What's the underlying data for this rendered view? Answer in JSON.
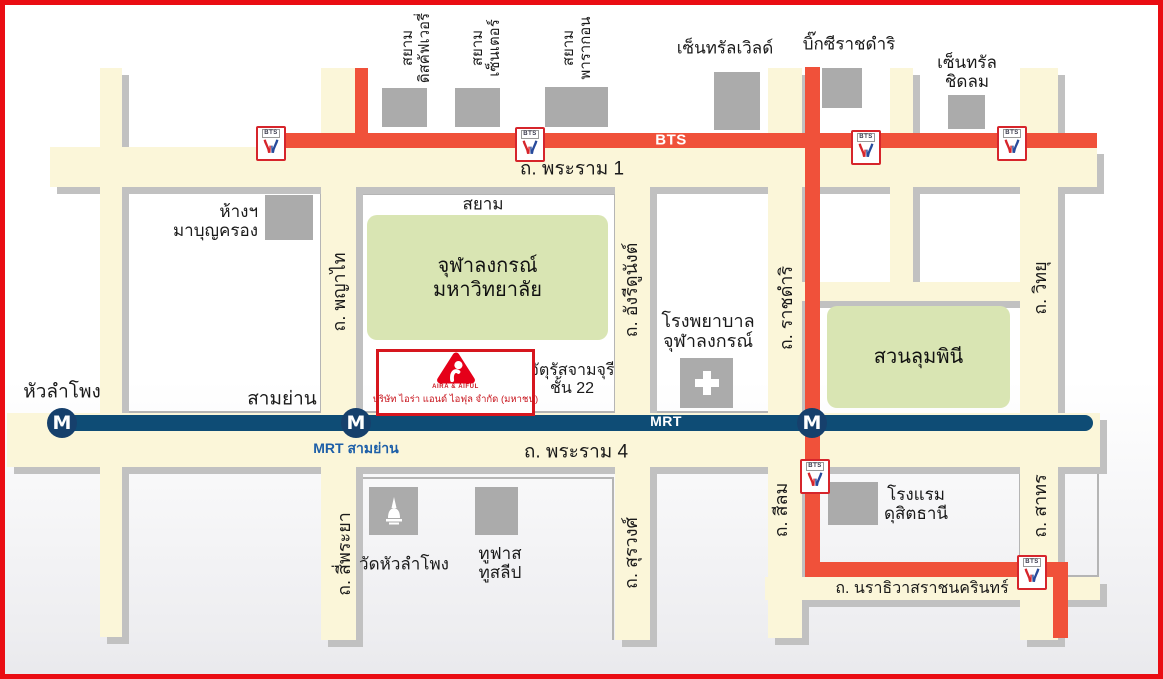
{
  "map": {
    "colors": {
      "frame_red": "#ea0d13",
      "road_cream": "#fbf6d9",
      "road_shadow": "#c1c1c1",
      "bts_orange": "#f0513a",
      "mrt_navy": "#0e4c75",
      "mrt_station_navy": "#16406c",
      "park_green": "#d9e5b3",
      "building_gray": "#ababab",
      "block_border": "#b5b5b5",
      "brand_red": "#c8161e",
      "mrt_label_blue": "#1d5fa8"
    },
    "roads": [
      {
        "id": "road-rama-1",
        "x": 50,
        "y": 147,
        "w": 1047,
        "h": 40
      },
      {
        "id": "road-rama-4",
        "x": 7,
        "y": 413,
        "w": 1093,
        "h": 54
      },
      {
        "id": "road-lumpini-north",
        "x": 800,
        "y": 282,
        "w": 256,
        "h": 19
      },
      {
        "id": "road-narathiwat",
        "x": 765,
        "y": 577,
        "w": 335,
        "h": 23
      },
      {
        "id": "road-far-left",
        "x": 100,
        "y": 68,
        "w": 22,
        "h": 569
      },
      {
        "id": "road-phayathai-siphraya",
        "x": 321,
        "y": 68,
        "w": 35,
        "h": 572
      },
      {
        "id": "road-henridunant-surawong",
        "x": 615,
        "y": 187,
        "w": 35,
        "h": 453
      },
      {
        "id": "road-ratchadamri-silom",
        "x": 768,
        "y": 68,
        "w": 34,
        "h": 570
      },
      {
        "id": "road-chidlom",
        "x": 890,
        "y": 68,
        "w": 23,
        "h": 232
      },
      {
        "id": "road-witthayu-sathorn",
        "x": 1020,
        "y": 68,
        "w": 38,
        "h": 572
      }
    ],
    "blocks": [
      {
        "id": "block-mbk",
        "x": 122,
        "y": 190,
        "w": 200,
        "h": 223,
        "open_bottom": false
      },
      {
        "id": "block-siam-chula",
        "x": 356,
        "y": 193,
        "w": 260,
        "h": 220,
        "open_bottom": false
      },
      {
        "id": "block-hospital",
        "x": 649,
        "y": 190,
        "w": 121,
        "h": 223,
        "open_bottom": false
      },
      {
        "id": "block-wat",
        "x": 357,
        "y": 477,
        "w": 257,
        "h": 163,
        "open_bottom": true
      },
      {
        "id": "block-dusit",
        "x": 795,
        "y": 470,
        "w": 226,
        "h": 107,
        "open_bottom": false
      },
      {
        "id": "block-sathorn-east",
        "x": 1058,
        "y": 470,
        "w": 41,
        "h": 107,
        "open_bottom": false
      }
    ],
    "parks": [
      {
        "id": "park-chulalongkorn-university",
        "label": "จุฬาลงกรณ์\nมหาวิทยาลัย",
        "x": 367,
        "y": 215,
        "w": 241,
        "h": 125
      },
      {
        "id": "park-lumpini",
        "label": "สวนลุมพินี",
        "x": 827,
        "y": 306,
        "w": 183,
        "h": 102
      }
    ],
    "buildings": [
      {
        "id": "building-siam-discovery",
        "x": 382,
        "y": 88,
        "w": 45,
        "h": 39,
        "icon": ""
      },
      {
        "id": "building-siam-center",
        "x": 455,
        "y": 88,
        "w": 45,
        "h": 39,
        "icon": ""
      },
      {
        "id": "building-siam-paragon",
        "x": 545,
        "y": 87,
        "w": 63,
        "h": 40,
        "icon": ""
      },
      {
        "id": "building-central-world",
        "x": 714,
        "y": 72,
        "w": 46,
        "h": 58,
        "icon": ""
      },
      {
        "id": "building-bigc-ratchadamri",
        "x": 822,
        "y": 68,
        "w": 40,
        "h": 40,
        "icon": ""
      },
      {
        "id": "building-central-chidlom",
        "x": 948,
        "y": 95,
        "w": 37,
        "h": 34,
        "icon": ""
      },
      {
        "id": "building-mbk",
        "x": 265,
        "y": 195,
        "w": 48,
        "h": 45,
        "icon": ""
      },
      {
        "id": "building-chula-hospital",
        "x": 680,
        "y": 358,
        "w": 53,
        "h": 50,
        "icon": "hospital-cross"
      },
      {
        "id": "building-wat-hua-lamphong",
        "x": 369,
        "y": 487,
        "w": 49,
        "h": 48,
        "icon": "stupa"
      },
      {
        "id": "building-toofast-tosleep",
        "x": 475,
        "y": 487,
        "w": 43,
        "h": 48,
        "icon": ""
      },
      {
        "id": "building-dusit-thani",
        "x": 828,
        "y": 482,
        "w": 50,
        "h": 43,
        "icon": ""
      }
    ],
    "bts": {
      "logo_text": "BTS",
      "segments": [
        {
          "id": "bts-sukhumvit-main",
          "x": 269,
          "y": 133,
          "w": 828,
          "h": 15
        },
        {
          "id": "bts-phayathai-branch",
          "x": 355,
          "y": 68,
          "w": 13,
          "h": 80
        },
        {
          "id": "bts-ratchadamri-branch",
          "x": 805,
          "y": 67,
          "w": 15,
          "h": 496
        },
        {
          "id": "bts-silom-horizontal",
          "x": 805,
          "y": 562,
          "w": 248,
          "h": 15
        },
        {
          "id": "bts-sathorn-tail",
          "x": 1053,
          "y": 562,
          "w": 15,
          "h": 76
        }
      ],
      "stations": [
        {
          "id": "bts-station-national-stadium",
          "cx": 269,
          "cy": 141
        },
        {
          "id": "bts-station-siam",
          "cx": 528,
          "cy": 142
        },
        {
          "id": "bts-station-chidlom",
          "cx": 864,
          "cy": 145
        },
        {
          "id": "bts-station-phloenchit",
          "cx": 1010,
          "cy": 141
        },
        {
          "id": "bts-station-saladaeng",
          "cx": 813,
          "cy": 474
        },
        {
          "id": "bts-station-chongnonsi",
          "cx": 1030,
          "cy": 570
        }
      ]
    },
    "mrt": {
      "station_letter": "M",
      "line": {
        "id": "mrt-blue-line",
        "x": 55,
        "y": 415,
        "w": 1038,
        "h": 16
      },
      "stations": [
        {
          "id": "mrt-station-hua-lamphong",
          "cx": 62,
          "cy": 423
        },
        {
          "id": "mrt-station-sam-yan",
          "cx": 356,
          "cy": 423
        },
        {
          "id": "mrt-station-silom",
          "cx": 812,
          "cy": 423
        }
      ]
    },
    "labels": [
      {
        "id": "label-siam-discovery",
        "text": "สยาม\nดิสคัฟเวอรี่",
        "x": 417,
        "y": 48,
        "fs": 15,
        "style": "v"
      },
      {
        "id": "label-siam-center",
        "text": "สยาม\nเซ็นเตอร์",
        "x": 487,
        "y": 48,
        "fs": 15,
        "style": "v"
      },
      {
        "id": "label-siam-paragon",
        "text": "สยาม\nพารากอน",
        "x": 578,
        "y": 48,
        "fs": 15,
        "style": "v"
      },
      {
        "id": "label-central-world",
        "text": "เซ็นทรัลเวิลด์",
        "x": 725,
        "y": 48,
        "fs": 17,
        "style": ""
      },
      {
        "id": "label-bigc-ratchadamri",
        "text": "บิ๊กซีราชดำริ",
        "x": 849,
        "y": 44,
        "fs": 17,
        "style": ""
      },
      {
        "id": "label-central-chidlom",
        "text": "เซ็นทรัล\nชิดลม",
        "x": 967,
        "y": 72,
        "fs": 17,
        "style": ""
      },
      {
        "id": "label-rama-1",
        "text": "ถ. พระราม 1",
        "x": 572,
        "y": 169,
        "fs": 19,
        "style": ""
      },
      {
        "id": "label-bts-line",
        "text": "BTS",
        "x": 671,
        "y": 141,
        "fs": 15,
        "style": "white"
      },
      {
        "id": "label-mbk",
        "text": "ห้างฯ\nมาบุญครอง",
        "x": 258,
        "y": 221,
        "fs": 17,
        "style": "right"
      },
      {
        "id": "label-siam-area",
        "text": "สยาม",
        "x": 483,
        "y": 204,
        "fs": 17,
        "style": ""
      },
      {
        "id": "label-phayathai",
        "text": "ถ. พญาไท",
        "x": 339,
        "y": 292,
        "fs": 18,
        "style": "v"
      },
      {
        "id": "label-henri-dunant",
        "text": "ถ. อังรีดูนังต์",
        "x": 631,
        "y": 290,
        "fs": 18,
        "style": "v"
      },
      {
        "id": "label-chula-hospital",
        "text": "โรงพยาบาล\nจุฬาลงกรณ์",
        "x": 708,
        "y": 331,
        "fs": 18,
        "style": ""
      },
      {
        "id": "label-ratchadamri",
        "text": "ถ. ราชดำริ",
        "x": 786,
        "y": 308,
        "fs": 18,
        "style": "v"
      },
      {
        "id": "label-witthayu",
        "text": "ถ. วิทยุ",
        "x": 1040,
        "y": 288,
        "fs": 18,
        "style": "v"
      },
      {
        "id": "label-hua-lamphong",
        "text": "หัวลำโพง",
        "x": 62,
        "y": 392,
        "fs": 19,
        "style": ""
      },
      {
        "id": "label-sam-yan",
        "text": "สามย่าน",
        "x": 282,
        "y": 399,
        "fs": 19,
        "style": ""
      },
      {
        "id": "label-chamchuri-square",
        "text": "จัตุรัสจามจุรี\nชั้น 22",
        "x": 572,
        "y": 380,
        "fs": 16,
        "style": ""
      },
      {
        "id": "label-mrt-line",
        "text": "MRT",
        "x": 666,
        "y": 422,
        "fs": 14,
        "style": "white"
      },
      {
        "id": "label-mrt-sam-yan",
        "text": "MRT สามย่าน",
        "x": 356,
        "y": 449,
        "fs": 14,
        "style": "blue"
      },
      {
        "id": "label-rama-4",
        "text": "ถ. พระราม 4",
        "x": 576,
        "y": 452,
        "fs": 19,
        "style": ""
      },
      {
        "id": "label-si-phraya",
        "text": "ถ. สี่พระยา",
        "x": 344,
        "y": 554,
        "fs": 18,
        "style": "v"
      },
      {
        "id": "label-wat-hua-lamphong",
        "text": "วัดหัวลำโพง",
        "x": 404,
        "y": 564,
        "fs": 17,
        "style": ""
      },
      {
        "id": "label-toofast-tosleep",
        "text": "ทูฟาส\nทูสลีป",
        "x": 500,
        "y": 563,
        "fs": 17,
        "style": ""
      },
      {
        "id": "label-surawong",
        "text": "ถ. สุรวงศ์",
        "x": 631,
        "y": 553,
        "fs": 18,
        "style": "v"
      },
      {
        "id": "label-silom",
        "text": "ถ. สีลม",
        "x": 781,
        "y": 510,
        "fs": 18,
        "style": "v"
      },
      {
        "id": "label-dusit-thani",
        "text": "โรงแรม\nดุสิตธานี",
        "x": 916,
        "y": 504,
        "fs": 17,
        "style": ""
      },
      {
        "id": "label-sathorn",
        "text": "ถ. สาทร",
        "x": 1040,
        "y": 506,
        "fs": 18,
        "style": "v"
      },
      {
        "id": "label-narathiwat",
        "text": "ถ. นราธิวาสราชนครินทร์",
        "x": 922,
        "y": 589,
        "fs": 16,
        "style": ""
      }
    ],
    "aira": {
      "x": 376,
      "y": 349,
      "w": 153,
      "h": 61,
      "logo_caption": "AIRA & AIFUL",
      "company": "บริษัท ไอร่า แอนด์ ไอฟุล จำกัด (มหาชน)"
    }
  }
}
